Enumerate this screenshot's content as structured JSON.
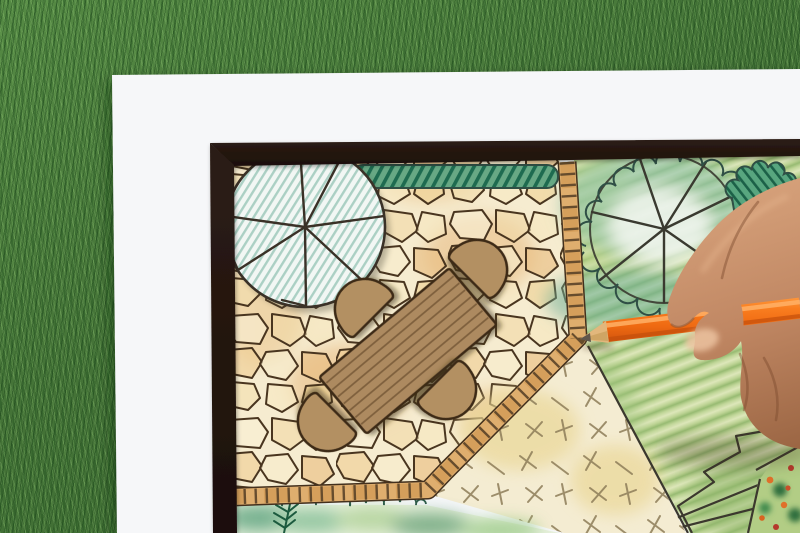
{
  "scene": {
    "type": "photograph",
    "subject": "hand drawing a garden landscape design plan with an orange colored pencil",
    "background": "green grass lawn",
    "paper": "white sheet with hand-drawn garden plan inside a dark border frame",
    "plan_elements": [
      "large round tree canopy symbol with radiating branch lines",
      "dark green hedge row",
      "flagstone patio",
      "rectangular wooden dining table",
      "four rounded chairs",
      "paver edging strips",
      "lawn area with cross hatch marks",
      "green striped lawn area",
      "second tree canopy with scalloped shrub outlines",
      "dark hatched bush",
      "planting bed with fern",
      "corner flower bed with orange and red blooms"
    ],
    "hand": "right hand gripping pencil, entering from right edge",
    "pencil": "orange colored pencil with wooden tip touching the patio edge"
  },
  "palette": {
    "grass": "#4b7c3c",
    "paper": "#f6f7f9",
    "frame": "#241712",
    "ink": "#49351f",
    "stoneFill": "#f6ecd0",
    "stoneWash": "#e5b377",
    "edgingTan": "#dfae6e",
    "edgingDark": "#5a4228",
    "furniture": "#b39062",
    "furnitureLine": "#7e5f3c",
    "furnitureOutline": "#3c2b18",
    "treeFill": "#f2f7f4",
    "treeHatch": "#9fc9bc",
    "hedgeBase": "#67a884",
    "hedgeDark": "#1e6b50",
    "gardenBase": "#edf2da",
    "cream": "#f4ecd2",
    "crossMark": "#8d7c58",
    "bedBase": "#e7f0dc",
    "fern": "#1c5a3e",
    "scallopInk": "#2f4f45",
    "boundaryInk": "#3b382e",
    "pencilOrange": "#ef6a12",
    "pencilWood": "#e2b77c",
    "pencilLead": "#5f564c",
    "skinLight": "#d9a57e",
    "skinMid": "#c08763",
    "skinDark": "#96613f"
  }
}
